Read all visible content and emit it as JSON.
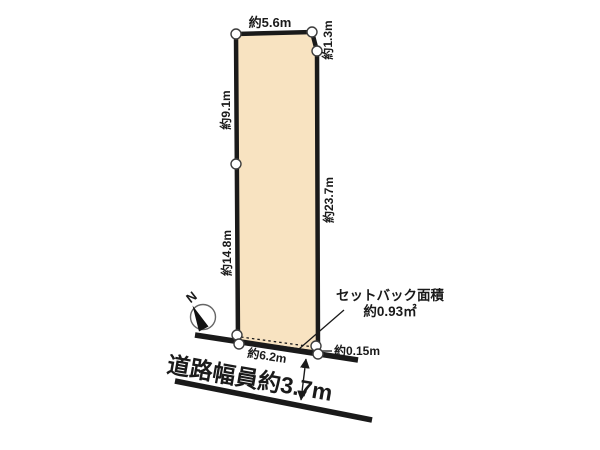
{
  "colors": {
    "background": "#ffffff",
    "parcel_fill": "#f8e3c1",
    "line": "#1a1a1a",
    "marker_fill": "#ffffff",
    "marker_stroke": "#3d3d3d"
  },
  "parcel": {
    "edge_labels": {
      "top": "約5.6m",
      "top_right": "約1.3m",
      "left_upper": "約9.1m",
      "left_lower": "約14.8m",
      "right": "約23.7m",
      "front": "約6.2m"
    }
  },
  "setback": {
    "title": "セットバック面積",
    "area": "約0.93㎡",
    "offset": "約0.15m"
  },
  "road": {
    "width_label": "道路幅員約3.7m"
  },
  "compass": {
    "north": "N"
  }
}
